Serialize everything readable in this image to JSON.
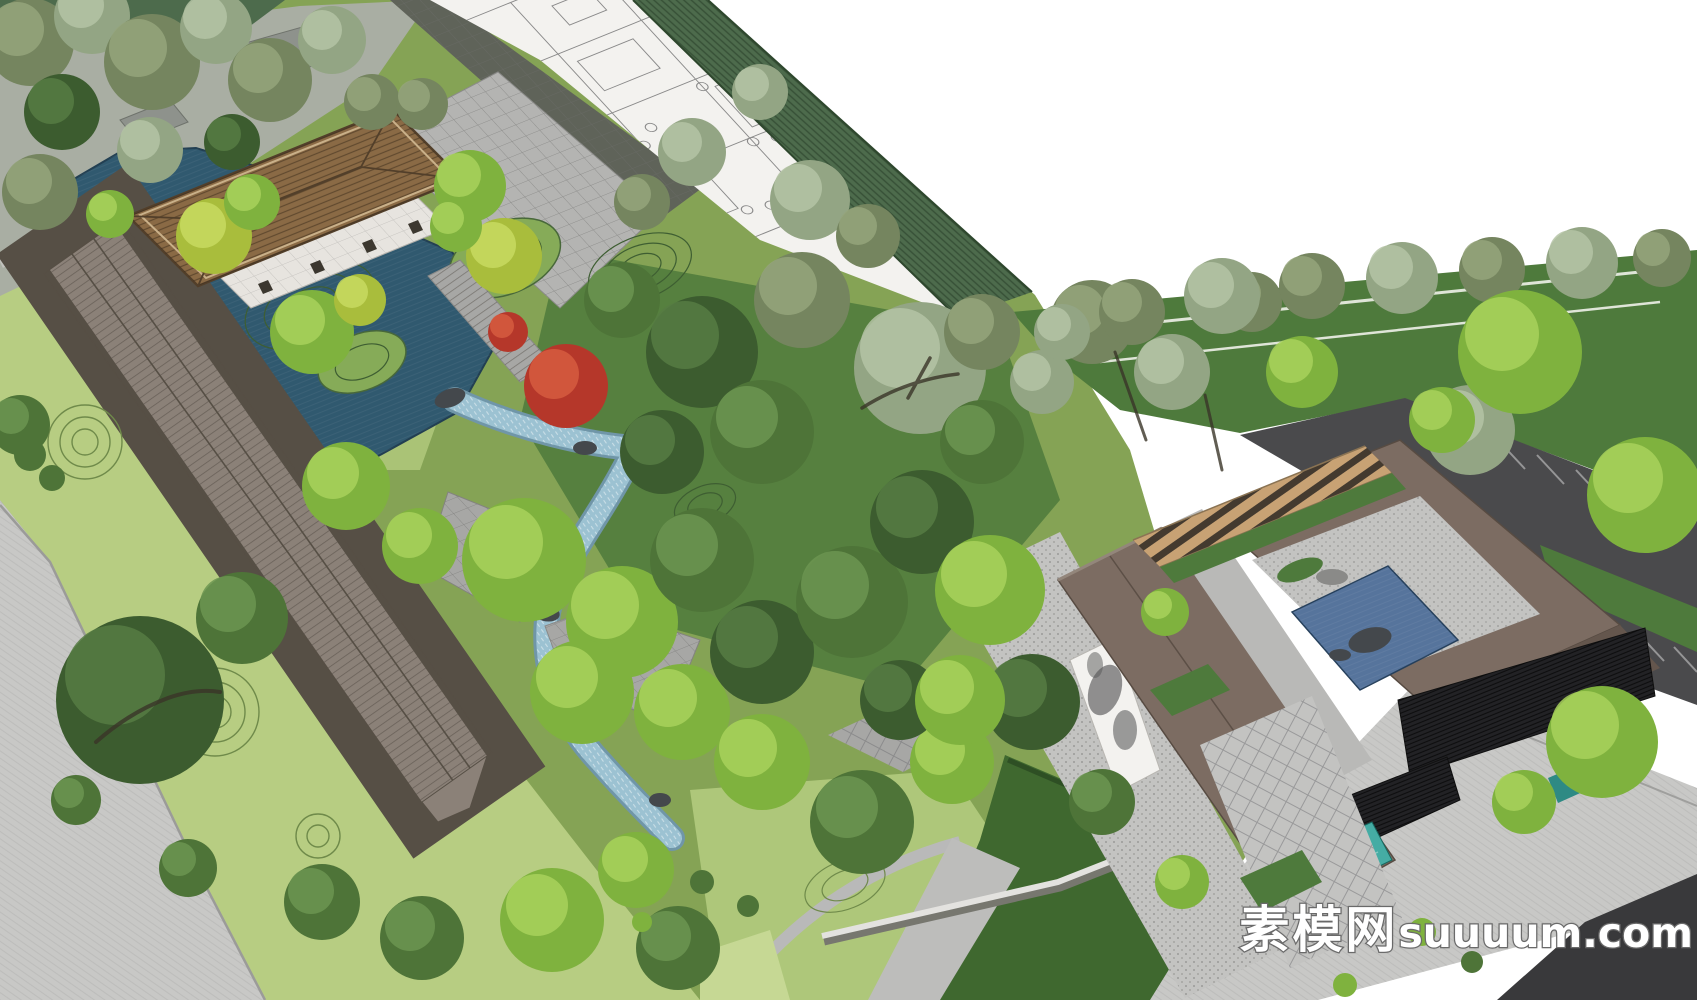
{
  "watermark": {
    "brand_cn": "素模网",
    "brand_domain": "suuuum.com"
  },
  "palette": {
    "white": "#ffffff",
    "road_light": "#c8c8c6",
    "road_dark": "#4a4a4c",
    "corner_dark": "#39393b",
    "lawn_light": "#b7cd82",
    "lawn_mid": "#85a355",
    "lawn_green": "#4e7a3c",
    "lawn_dark": "#3f682f",
    "mound_light": "#aec77a",
    "island": "#86ab58",
    "hedge": "#4d6b4c",
    "pond": "#30596f",
    "stream": "#9cc2d2",
    "stream_edge": "#7096a8",
    "pool_blue": "#56749c",
    "pool_teal": "#45aca4",
    "rock": "#44484c",
    "pave_light": "#c3c3c1",
    "pave_mid": "#a7a7a5",
    "roof_tile": "#5f6359",
    "walk_roof": "#8b8178",
    "walk_edge": "#564f45",
    "pavilion_roof": "#8a6a45",
    "pavilion_dark": "#523f2a",
    "platform": "#e7e4df",
    "building": "#7c6c62",
    "building_dark": "#64564d",
    "wall_white": "#f3f2ef",
    "pergola": "#c8a274",
    "pergola_dark": "#443a2f",
    "canopy": "#222225",
    "plan_line": "#8a8a8a",
    "contour": "#3e5e32",
    "contour_light": "#6f8a4a",
    "trunk": "#3a3428",
    "tree_bright": "#7fb23e",
    "tree_bright_hi": "#a8d15c",
    "tree_yellow": "#a9bd3c",
    "tree_yellow_hi": "#c8da60",
    "tree_olive": "#75855f",
    "tree_olive_hi": "#95a57b",
    "tree_sage": "#93a584",
    "tree_sage_hi": "#b4c3a5",
    "tree_dark": "#4e7438",
    "tree_dark_hi": "#6c9551",
    "tree_deep": "#3c5c2f",
    "tree_deep_hi": "#567b43",
    "tree_red": "#b5372a",
    "tree_red_hi": "#d65c3f",
    "wm_fill": "#ffffff",
    "wm_outline": "#6e6e6e"
  }
}
